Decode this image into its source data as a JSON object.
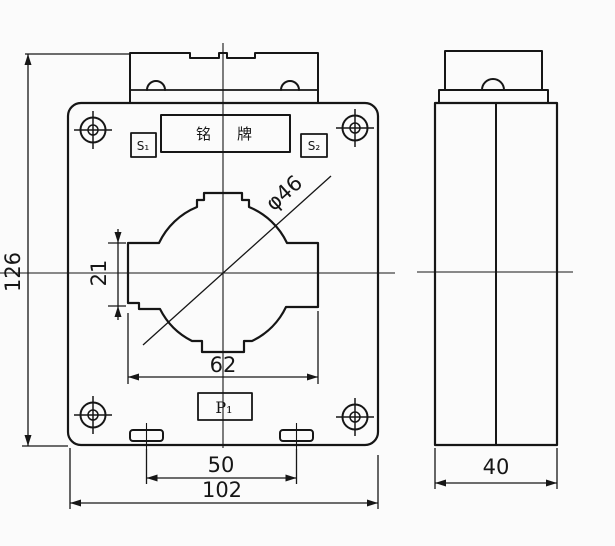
{
  "front_view": {
    "nameplate": "铭牌",
    "terminal_s1": "S₁",
    "terminal_s2": "S₂",
    "terminal_p1": "P₁"
  },
  "dimensions": {
    "overall_height": "126",
    "window_side_height": "21",
    "window_width": "62",
    "aperture": "φ46",
    "mounting_slot_spacing": "50",
    "overall_width": "102",
    "side_depth": "40"
  },
  "colors": {
    "line": "#161616",
    "background": "#fbfbfb"
  }
}
